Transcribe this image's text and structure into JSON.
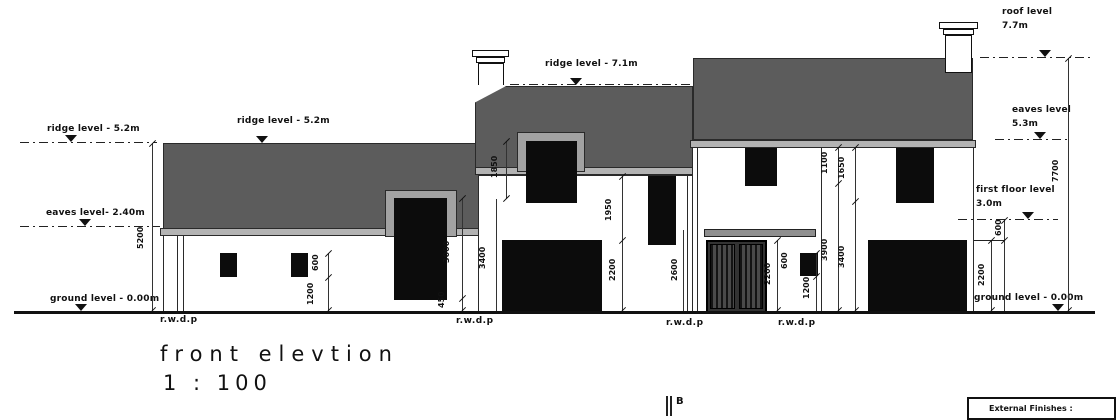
{
  "drawing_title": "front elevtion",
  "drawing_scale": "1 : 100",
  "levels": {
    "ridge_left": "ridge level - 5.2m",
    "ridge_left_2": "ridge level - 5.2m",
    "ridge_mid": "ridge level - 7.1m",
    "roof_right_line1": "roof level",
    "roof_right_line2": "7.7m",
    "eaves_left": "eaves level- 2.40m",
    "eaves_right_line1": "eaves level",
    "eaves_right_line2": "5.3m",
    "first_floor_line1": "first floor level",
    "first_floor_line2": "3.0m",
    "ground_left": "ground level - 0.00m",
    "ground_right": "ground level - 0.00m"
  },
  "dimensions": {
    "left_overall": "5200",
    "left_window_height": "600",
    "left_window_sill": "1200",
    "left_garage_height": "3000",
    "left_garage_below": "450",
    "left_garage_overall": "3400",
    "dormer_height": "1850",
    "mid_window_height": "1950",
    "mid_garage_height": "2200",
    "door_canopy": "2600",
    "door_height": "2200",
    "door_window_height": "600",
    "door_window_sill": "1200",
    "right_drop_a": "3900",
    "right_drop_b": "3400",
    "right_eaves_a": "1100",
    "right_eaves_b": "1650",
    "right_step": "600",
    "right_garage_height": "2200",
    "right_overall": "7700"
  },
  "annotations": {
    "rwdp": "r.w.d.p",
    "section_marker": "B",
    "external_finishes": "External Finishes :"
  },
  "colors": {
    "roof": "#5c5c5c",
    "fascia": "#b3b3b3",
    "frame": "#a2a2a2",
    "canopy": "#8f8f8f",
    "opening": "#0c0c0c"
  }
}
